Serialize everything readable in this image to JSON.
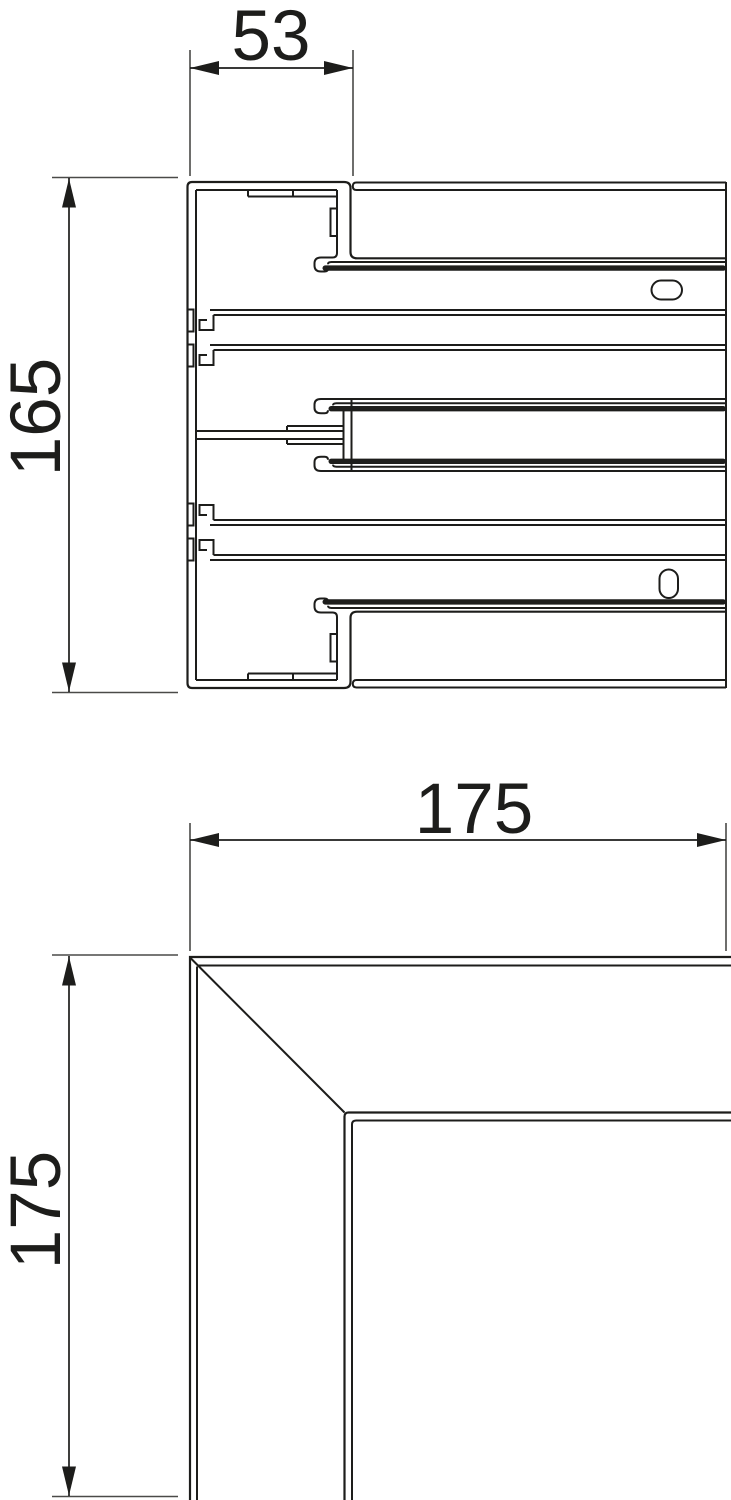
{
  "style": {
    "background": "#ffffff",
    "line_color": "#1d1d1b"
  },
  "views": {
    "cross_section": {
      "width_label": "53",
      "height_label": "165"
    },
    "corner": {
      "width_label": "175",
      "height_label": "175"
    }
  }
}
